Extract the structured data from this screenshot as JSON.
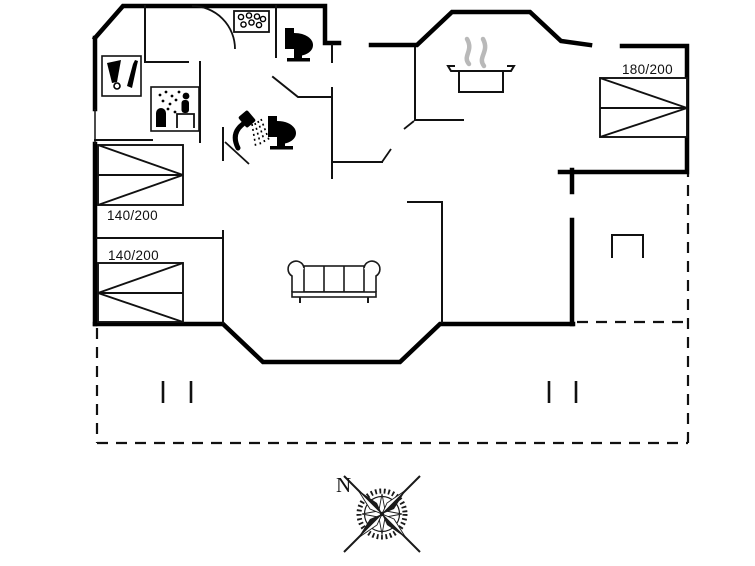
{
  "plan": {
    "bed_labels": [
      {
        "id": "bed-left-upper",
        "label": "140/200"
      },
      {
        "id": "bed-left-lower",
        "label": "140/200"
      },
      {
        "id": "bed-right",
        "label": "180/200"
      }
    ],
    "compass": {
      "north_label": "N"
    },
    "colors": {
      "wall": "#000000",
      "thin_line": "#111111",
      "steam": "#b9b9b9",
      "compass": "#1a1a1a",
      "background": "#ffffff"
    },
    "icons": [
      "wine-bottle-glass-icon",
      "sauna-icon",
      "whirlpool-tub-icon",
      "toilet-icon",
      "shower-icon",
      "cooking-pot-icon",
      "sofa-icon",
      "compass-rose-icon"
    ]
  }
}
